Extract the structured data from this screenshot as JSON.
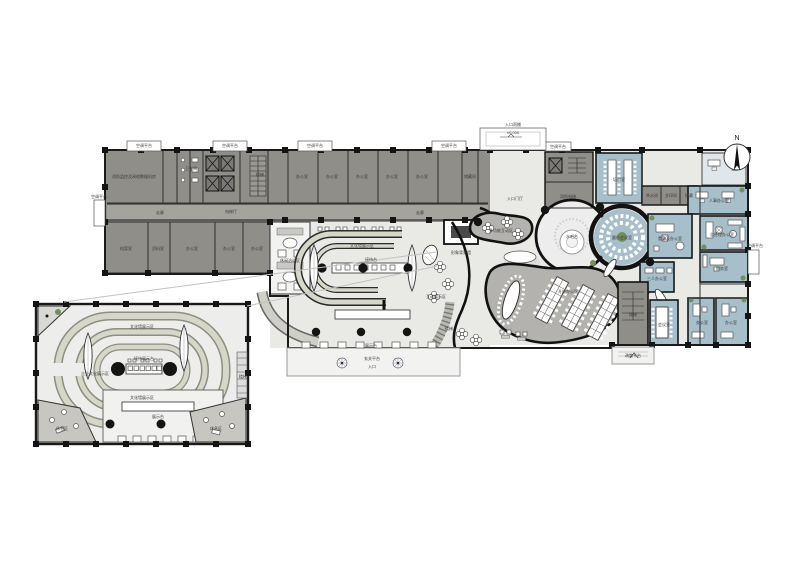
{
  "north": {
    "label": "N"
  },
  "colors": {
    "dark-room": "#908e89",
    "corridor": "#a5a39e",
    "floor": "#e9e9e6",
    "blue-room": "#a7bfca",
    "olive-band": "#d6d6c9",
    "olive-edge": "#8d8d80",
    "organic": "#b3b2ae",
    "green-plant": "#6f8f5f",
    "platform": "#f2f2f0",
    "wall": "#1a1a1a"
  },
  "plan_labels": [
    {
      "t": "空调平台",
      "x": 144,
      "y": 147,
      "fs": 3.2
    },
    {
      "t": "空调平台",
      "x": 230,
      "y": 147,
      "fs": 3.2
    },
    {
      "t": "空调平台",
      "x": 315,
      "y": 147,
      "fs": 3.2
    },
    {
      "t": "空调平台",
      "x": 449,
      "y": 147,
      "fs": 3.2
    },
    {
      "t": "空调平台",
      "x": 558,
      "y": 148,
      "fs": 3.2
    },
    {
      "t": "±0.000",
      "x": 513,
      "y": 134,
      "fs": 3.4
    },
    {
      "t": "入口雨棚",
      "x": 513,
      "y": 126,
      "fs": 3.2
    },
    {
      "t": "空调平台",
      "x": 99,
      "y": 198,
      "fs": 3
    },
    {
      "t": "空调平台",
      "x": 755,
      "y": 247,
      "fs": 3
    },
    {
      "t": "消防监控及网络数据机房",
      "x": 134,
      "y": 178,
      "fs": 3.2
    },
    {
      "t": "卫生间",
      "x": 191,
      "y": 170,
      "fs": 3
    },
    {
      "t": "电梯厅",
      "x": 231,
      "y": 213,
      "fs": 3.2
    },
    {
      "t": "楼梯",
      "x": 260,
      "y": 176,
      "fs": 3
    },
    {
      "t": "办公室",
      "x": 302,
      "y": 178
    },
    {
      "t": "办公室",
      "x": 332,
      "y": 178
    },
    {
      "t": "办公室",
      "x": 362,
      "y": 178
    },
    {
      "t": "办公室",
      "x": 392,
      "y": 178
    },
    {
      "t": "办公室",
      "x": 422,
      "y": 178
    },
    {
      "t": "储藏间",
      "x": 470,
      "y": 178,
      "fs": 3.2
    },
    {
      "t": "走廊",
      "x": 160,
      "y": 214,
      "fs": 3.2
    },
    {
      "t": "走廊",
      "x": 420,
      "y": 214,
      "fs": 3.2
    },
    {
      "t": "档案室",
      "x": 126,
      "y": 250
    },
    {
      "t": "资料室",
      "x": 158,
      "y": 250
    },
    {
      "t": "办公室",
      "x": 192,
      "y": 250
    },
    {
      "t": "办公室",
      "x": 229,
      "y": 250
    },
    {
      "t": "办公室",
      "x": 257,
      "y": 250
    },
    {
      "t": "消防电梯",
      "x": 568,
      "y": 198,
      "fs": 3
    },
    {
      "t": "入口门厅",
      "x": 515,
      "y": 200,
      "fs": 3.4
    },
    {
      "t": "形象背景墙",
      "x": 461,
      "y": 254,
      "fs": 3.2
    },
    {
      "t": "休闲洽谈区",
      "x": 290,
      "y": 262,
      "fs": 3.2
    },
    {
      "t": "文化墙展示区",
      "x": 362,
      "y": 247,
      "fs": 3.4
    },
    {
      "t": "接待台",
      "x": 371,
      "y": 261,
      "fs": 3.2
    },
    {
      "t": "展示台",
      "x": 371,
      "y": 347,
      "fs": 3.2
    },
    {
      "t": "玄关平台",
      "x": 372,
      "y": 360
    },
    {
      "t": "入口",
      "x": 372,
      "y": 368,
      "fs": 3.4
    },
    {
      "t": "互动展示区",
      "x": 436,
      "y": 298,
      "fs": 3.2
    },
    {
      "t": "楼梯",
      "x": 449,
      "y": 330,
      "fs": 3
    },
    {
      "t": "多功能互动区",
      "x": 501,
      "y": 232,
      "fs": 3.4
    },
    {
      "t": "水吧台",
      "x": 572,
      "y": 238,
      "fs": 3.4
    },
    {
      "t": "开放办公区",
      "x": 568,
      "y": 293,
      "fs": 3.6
    },
    {
      "t": "圆形会议室",
      "x": 622,
      "y": 239,
      "fs": 3.4
    },
    {
      "t": "培训室",
      "x": 619,
      "y": 181,
      "fs": 3.4
    },
    {
      "t": "茶水间",
      "x": 652,
      "y": 197,
      "fs": 2.8
    },
    {
      "t": "文印间",
      "x": 671,
      "y": 197,
      "fs": 2.8
    },
    {
      "t": "储藏",
      "x": 689,
      "y": 197,
      "fs": 2.8
    },
    {
      "t": "人事办公室",
      "x": 719,
      "y": 202,
      "fs": 3
    },
    {
      "t": "总经理办公室",
      "x": 722,
      "y": 236,
      "fs": 3
    },
    {
      "t": "董事长办公室",
      "x": 670,
      "y": 240,
      "fs": 3
    },
    {
      "t": "财务室",
      "x": 722,
      "y": 270,
      "fs": 3.2
    },
    {
      "t": "三人办公室",
      "x": 657,
      "y": 280,
      "fs": 3
    },
    {
      "t": "楼梯",
      "x": 633,
      "y": 316,
      "fs": 3
    },
    {
      "t": "会议室",
      "x": 664,
      "y": 326,
      "fs": 3.2
    },
    {
      "t": "办公室",
      "x": 702,
      "y": 324,
      "fs": 3.2
    },
    {
      "t": "办公室",
      "x": 731,
      "y": 324,
      "fs": 3.2
    },
    {
      "t": "疏散平台",
      "x": 633,
      "y": 357,
      "fs": 3
    },
    {
      "t": "文化墙展示区",
      "x": 142,
      "y": 328,
      "fs": 3.4
    },
    {
      "t": "企业文化展示区",
      "x": 95,
      "y": 375,
      "fs": 3
    },
    {
      "t": "接待展示台",
      "x": 144,
      "y": 360,
      "fs": 3
    },
    {
      "t": "文化墙展示区",
      "x": 142,
      "y": 399,
      "fs": 3.2
    },
    {
      "t": "展示台",
      "x": 158,
      "y": 418,
      "fs": 3.2
    },
    {
      "t": "休息区",
      "x": 62,
      "y": 430,
      "fs": 3
    },
    {
      "t": "休息区",
      "x": 216,
      "y": 430,
      "fs": 3
    },
    {
      "t": "楼梯",
      "x": 243,
      "y": 378,
      "fs": 2.8
    }
  ]
}
